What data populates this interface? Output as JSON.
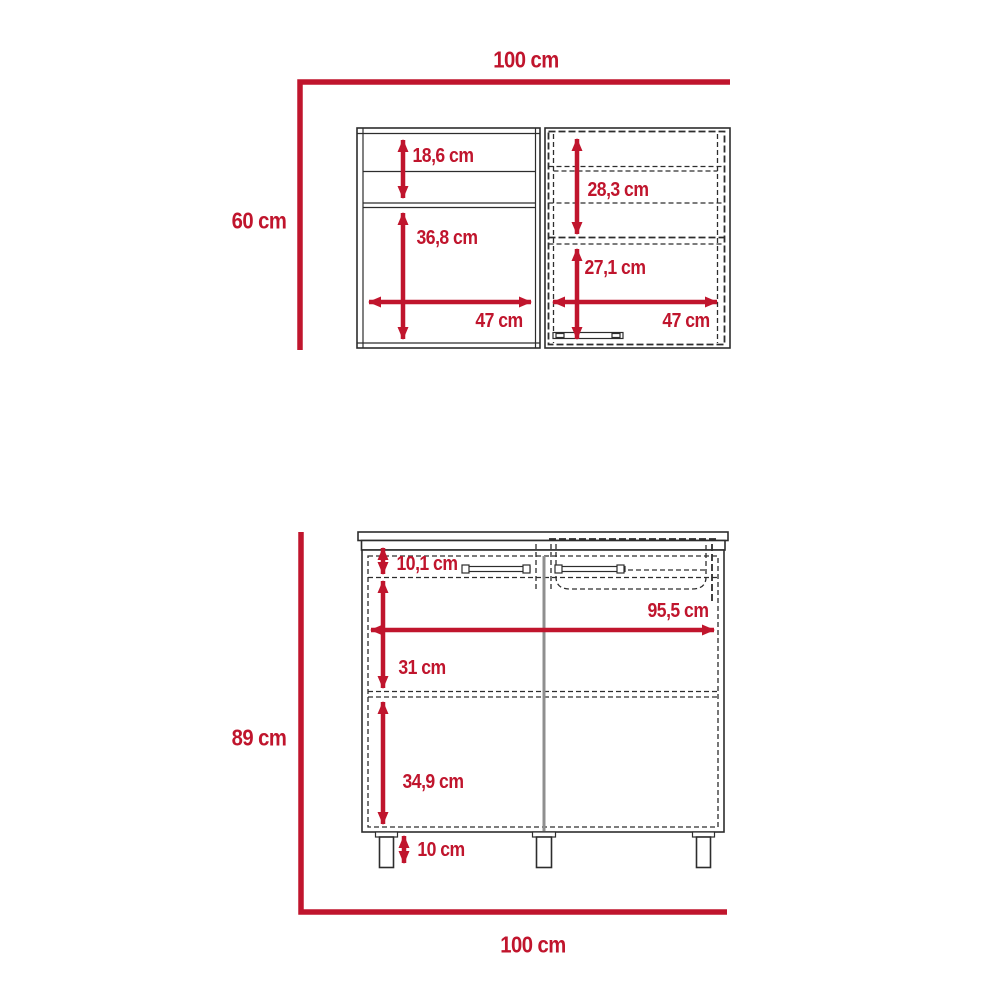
{
  "colors": {
    "dimension_red": "#c0152d",
    "line_dark": "#2d2d2d",
    "divider_gray": "#8f8f8f"
  },
  "upper_cabinet": {
    "overall_width": "100 cm",
    "overall_height": "60 cm",
    "open_section": {
      "top_shelf_height": "18,6 cm",
      "lower_compartment_height": "36,8 cm",
      "width": "47 cm"
    },
    "door_section": {
      "upper_compartment_height": "28,3 cm",
      "lower_compartment_height": "27,1 cm",
      "width": "47 cm"
    }
  },
  "base_cabinet": {
    "overall_width": "100 cm",
    "overall_height": "89 cm",
    "top_rail_height": "10,1 cm",
    "interior_width": "95,5 cm",
    "upper_compartment_height": "31 cm",
    "lower_compartment_height": "34,9 cm",
    "leg_height": "10 cm"
  }
}
